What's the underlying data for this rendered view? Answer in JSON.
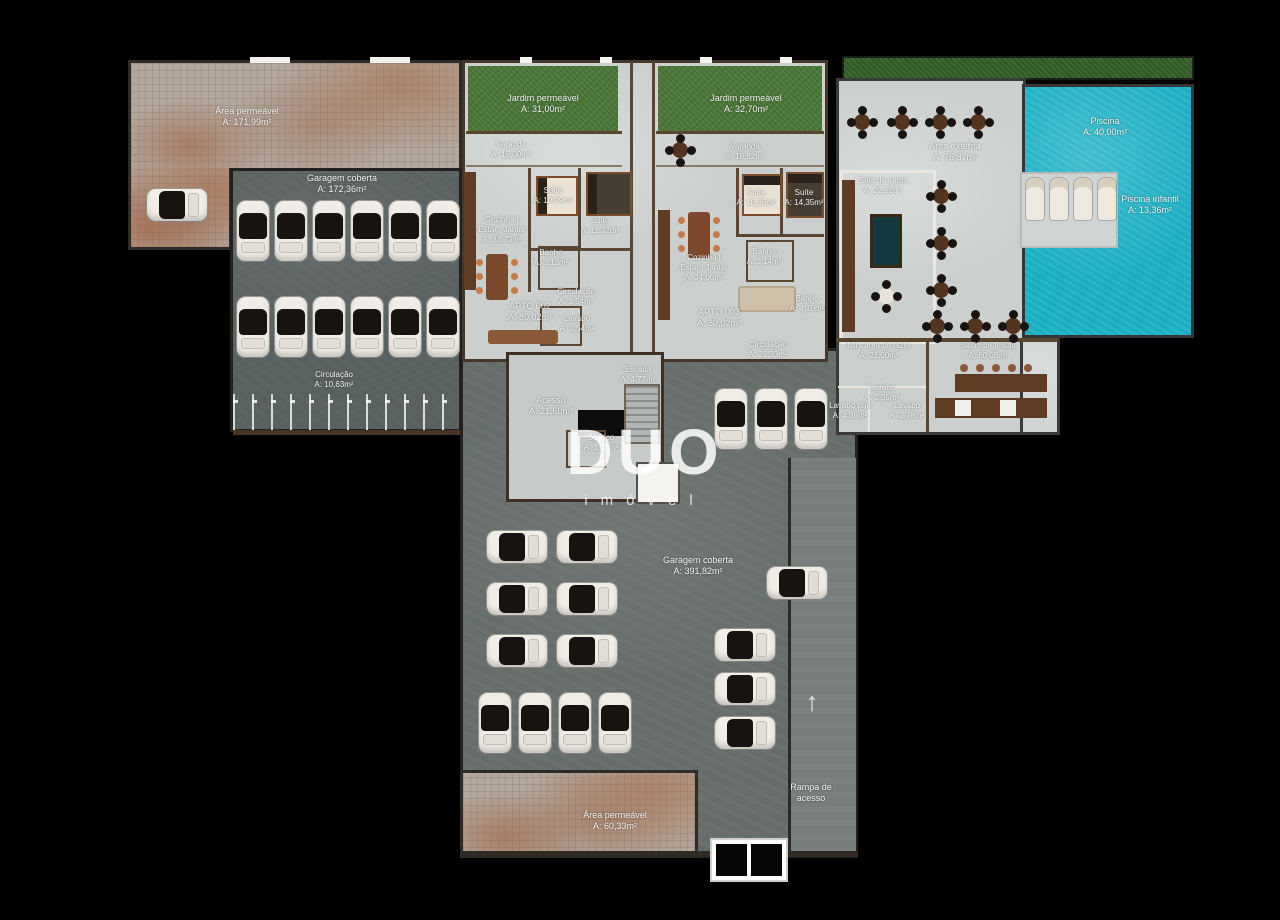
{
  "watermark": {
    "title": "DUO",
    "subtitle": "imóvel"
  },
  "icons": {
    "ramp_arrow": "↑"
  },
  "colors": {
    "background": "#000000",
    "paver": "#b4a89d",
    "garage_dark": "#596060",
    "garage_lower": "#666e6b",
    "apartment_floor": "#cbd0cf",
    "garden_green": "#4d7a39",
    "pool_teal": "#17aec2",
    "wall_brown": "#5a4631",
    "car_body": "#f0ede6",
    "chair_orange": "#c67a45"
  },
  "labels": {
    "area_permeavel_1": {
      "name": "Área permeável",
      "area": "A: 171,99m²"
    },
    "garagem_1": {
      "name": "Garagem coberta",
      "area": "A: 172,36m²"
    },
    "garagem_1_circulacao": {
      "name": "Circulação",
      "area": "A: 10,63m²"
    },
    "garagem_2": {
      "name": "Garagem coberta",
      "area": "A: 391,82m²"
    },
    "area_permeavel_2": {
      "name": "Área permeável",
      "area": "A: 60,33m²"
    },
    "rampa": {
      "l1": "Rampa de",
      "l2": "acesso"
    }
  },
  "apto_002": {
    "jardim": {
      "name": "Jardim permeável",
      "area": "A: 31,00m²"
    },
    "varanda": {
      "name": "Varanda",
      "area": "A: 15,00m²"
    },
    "cozinha": {
      "l1": "Cozinha |",
      "l2": "Estar | Jantar",
      "area": "A: 33,73m²"
    },
    "suite_1": {
      "name": "Suíte",
      "area": "A: 10,09m²"
    },
    "suite_2": {
      "name": "Suíte",
      "area": "A: 11,32m²"
    },
    "banho": {
      "name": "Banho",
      "area": "A: 3,13m²"
    },
    "circulacao": {
      "name": "Circulação",
      "area": "A: 3,54m²"
    },
    "lavabo": {
      "name": "Lavabo",
      "area": "A: 1,54m²"
    },
    "unidade": {
      "name": "APTO 002",
      "area": "A: 80,02m²"
    }
  },
  "apto_003": {
    "jardim": {
      "name": "Jardim permeável",
      "area": "A: 32,70m²"
    },
    "varanda": {
      "name": "Varanda",
      "area": "A: 18,62m²"
    },
    "cozinha": {
      "l1": "Cozinha |",
      "l2": "Estar | Jantar",
      "area": "A: 34,06m²"
    },
    "suite_1": {
      "name": "Suíte",
      "area": "A: 10,35m²"
    },
    "suite_2": {
      "name": "Suíte",
      "area": "A: 14,35m²"
    },
    "banho_1": {
      "name": "Banho",
      "area": "A: 3,14m²"
    },
    "banho_2": {
      "name": "Banho",
      "area": "A: 4,70m²"
    },
    "circulacao": {
      "name": "Circulação",
      "area": "A: 21,33m²"
    },
    "unidade": {
      "name": "APTO 003",
      "area": "A: 80,02m²"
    }
  },
  "core": {
    "escada": {
      "name": "Escada",
      "area": "A: 4,77m²"
    },
    "acesso": {
      "name": "Acesso",
      "area": "A: 21,60m²"
    },
    "servico": {
      "name": "Serviço",
      "area": "A: 1,35m²"
    }
  },
  "lazer": {
    "area_externa": {
      "name": "Área externa",
      "area": "A: 76,87m²"
    },
    "sala_jogos": {
      "name": "Sala de jogos",
      "area": "A: 22,92m²"
    },
    "piscina": {
      "name": "Piscina",
      "area": "A: 40,00m²"
    },
    "piscina_infantil": {
      "name": "Piscina infantil",
      "area": "A: 13,36m²"
    },
    "mini_lazer": {
      "name": "Mini área de lazer",
      "area": "A: 21,00m²"
    },
    "salao_festas": {
      "name": "Salão de festas",
      "area": "A: 60,08m²"
    },
    "lavabo_1": {
      "name": "Lavabo",
      "area": "A: 2,05m²"
    },
    "lavabo_pne": {
      "name": "Lavabo pne",
      "area": "A: 4,36m²"
    },
    "lavabo_2": {
      "name": "Lavabo",
      "area": "A: 2,78m²"
    }
  }
}
